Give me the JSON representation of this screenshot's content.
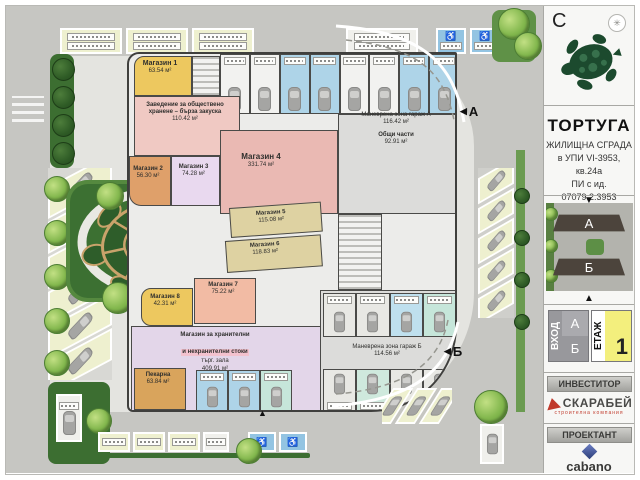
{
  "icons": {
    "left_arrow": "◀",
    "up_arrow": "▲",
    "down_arrow": "▼",
    "expand": "✳",
    "accessible": "♿"
  },
  "sidebar": {
    "north_letter": "С",
    "project": {
      "title": "ТОРТУГА",
      "lines": [
        "ЖИЛИЩНА СГРАДА",
        "в УПИ VI-3953, кв.24а",
        "ПИ с ид. 07079.2.3953",
        "по КК, гр. Бургас"
      ]
    },
    "render": {
      "building_a": "А",
      "building_b": "Б"
    },
    "selector": {
      "entrance_label": "ВХОД",
      "entrance_a": "А",
      "entrance_b": "Б",
      "floor_label": "ЕТАЖ",
      "floor_value": "1"
    },
    "investor_heading": "ИНВЕСТИТОР",
    "investor_name": "СКАРАБЕЙ",
    "investor_tagline": "строителна компания",
    "designer_heading": "ПРОЕКТАНТ",
    "designer_name": "cabano"
  },
  "plan": {
    "entrance_a": "А",
    "entrance_b": "Б",
    "rooms": {
      "shop1": {
        "name": "Магазин 1",
        "area": "63.54 м²"
      },
      "fastfood": {
        "name": "Заведение за обществено",
        "name2": "хранене – бърза закуска",
        "area": "110.42 м²"
      },
      "shop2": {
        "name": "Магазин 2",
        "area": "56.30 м²"
      },
      "shop3": {
        "name": "Магазин 3",
        "area": "74.28 м²"
      },
      "shop4": {
        "name": "Магазин 4",
        "area": "331.74 м²"
      },
      "shop5": {
        "name": "Магазин 5",
        "area": "115.08 м²"
      },
      "shop6": {
        "name": "Магазин 6",
        "area": "118.83 м²"
      },
      "shop7": {
        "name": "Магазин 7",
        "area": "75.22 м²"
      },
      "shop8": {
        "name": "Магазин 8",
        "area": "42.31 м²"
      },
      "market": {
        "name": "Магазин за хранителни",
        "name2": "и нехранителни стоки",
        "hall": "търг. зала",
        "area": "409.91 м²"
      },
      "bakery": {
        "name": "Пекарна",
        "area": "63.84 м²"
      },
      "maneuver_a": {
        "name": "Маневрена зона гараж А",
        "area": "116.42 м²"
      },
      "common": {
        "name": "Общи части",
        "area": "92.91 м²"
      },
      "maneuver_b": {
        "name": "Маневрена зона гараж Б",
        "area": "114.56 м²"
      }
    }
  },
  "colors": {
    "accent_yellow": "#edc85f",
    "accent_pink": "#f0c9c3",
    "accent_blue": "#aed4e8",
    "turtle_green": "#1c4a2e"
  }
}
